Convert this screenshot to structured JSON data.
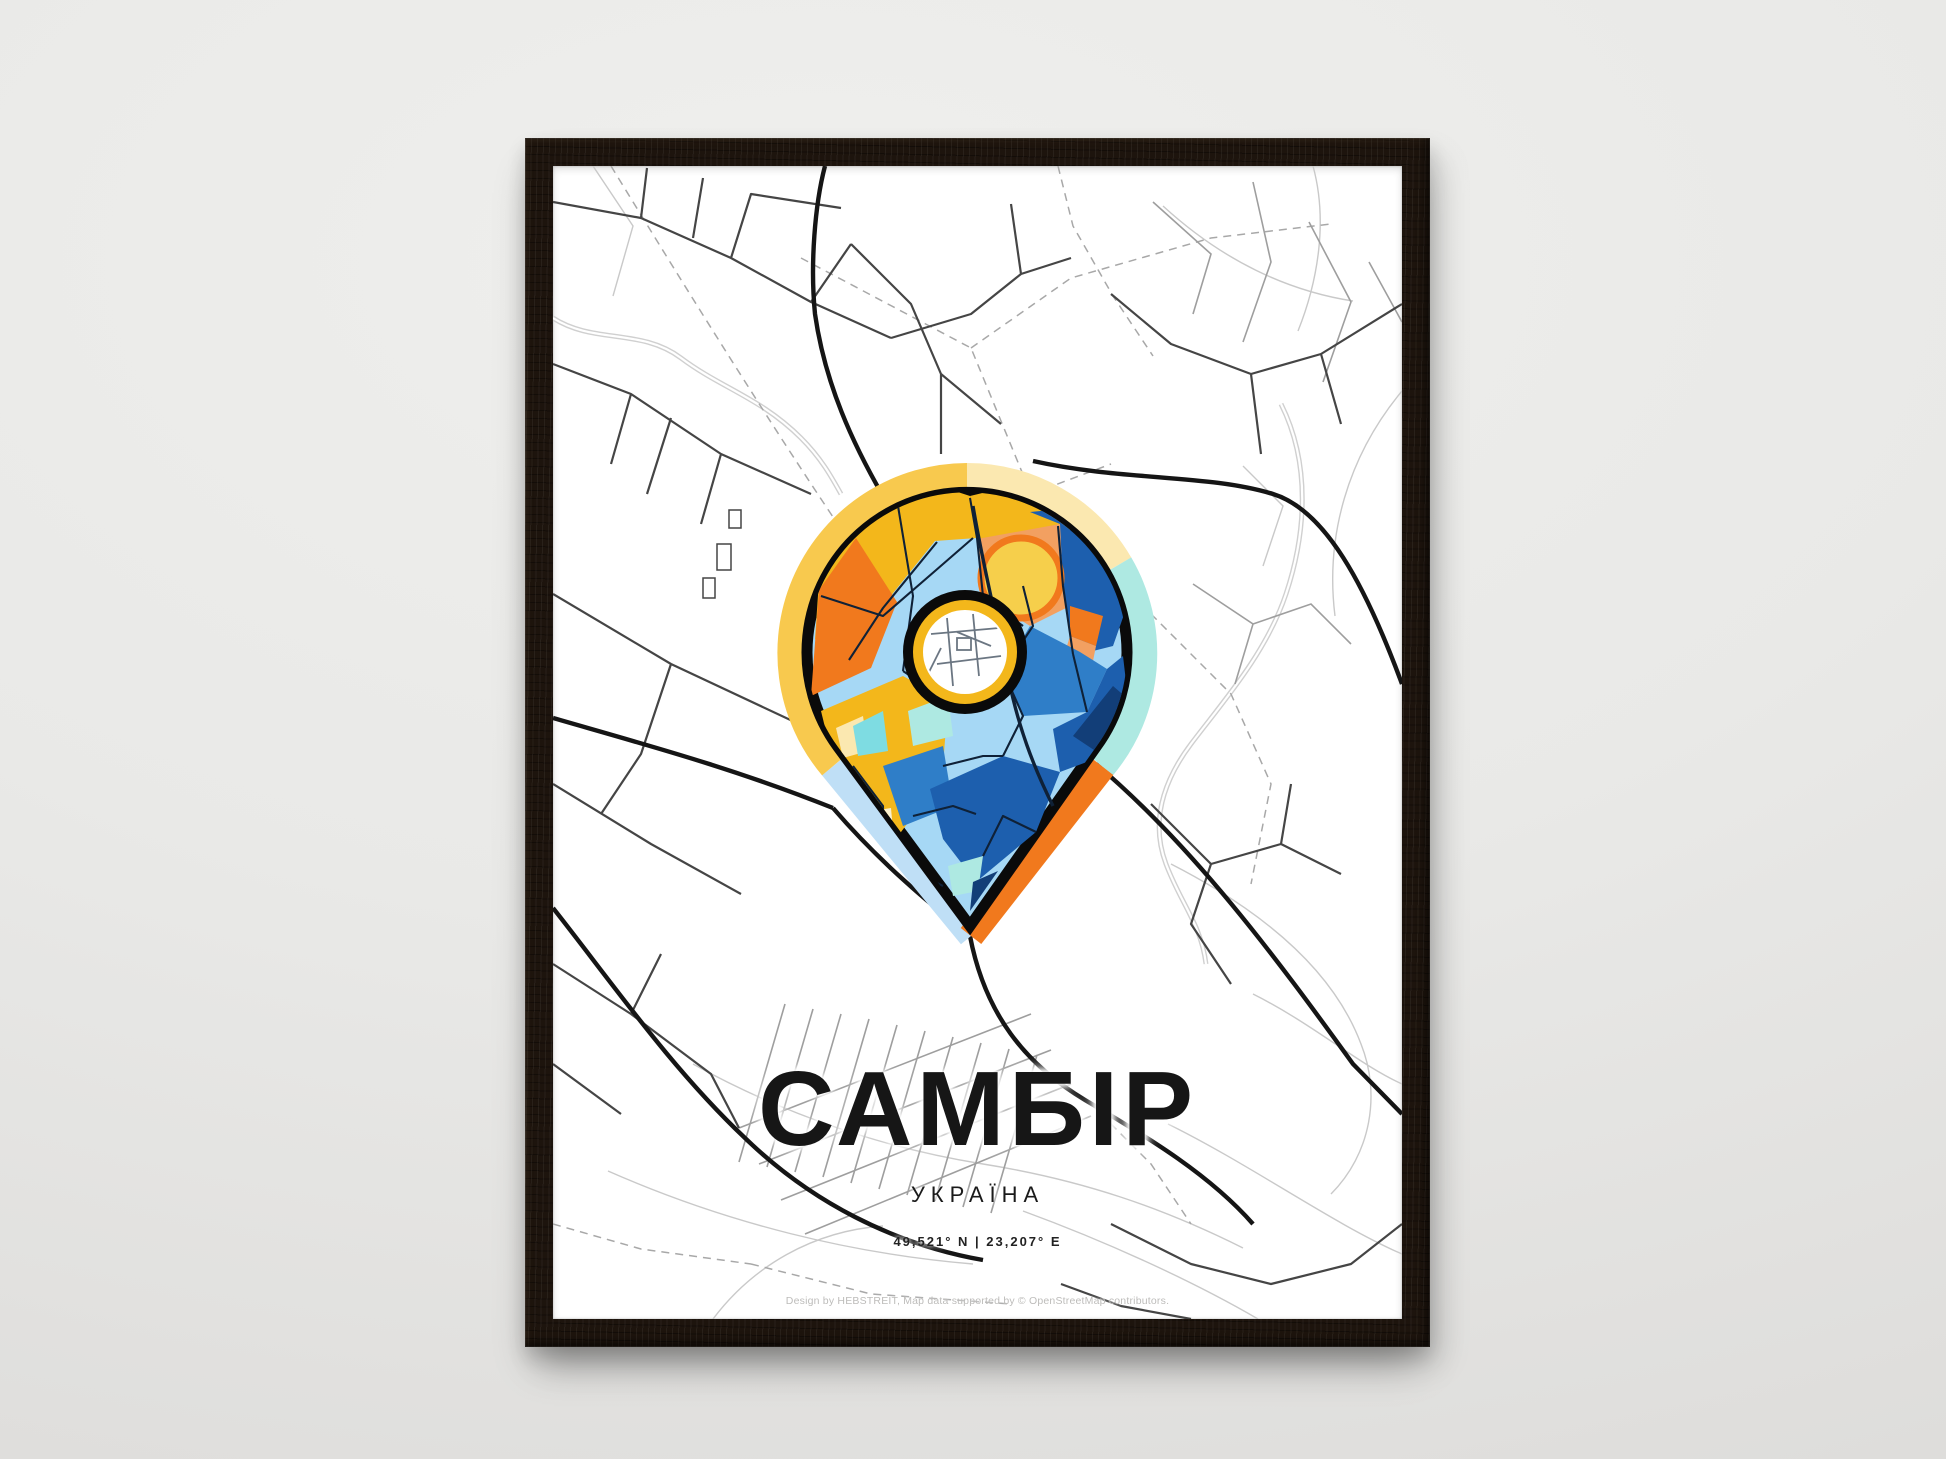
{
  "poster": {
    "title": "САМБІР",
    "subtitle": "УКРАЇНА",
    "coordinates": "49,521° N | 23,207° E",
    "credit": "Design by HEBSTREIT, Map data supported by © OpenStreetMap contributors."
  },
  "icons": {
    "pin": "map-pin-icon",
    "ring": "ring-roundabout-icon"
  },
  "colors": {
    "wall_top": "#efefed",
    "wall_bottom": "#dddcda",
    "frame_wood": "#1d140d",
    "paper": "#ffffff",
    "road_light": "#c9c9c9",
    "road_mid": "#9e9e9e",
    "road_dark": "#454545",
    "road_bold": "#151515",
    "road_dash": "#a8a8a8",
    "river": "#d0d0d0",
    "pin_gold": "#F3B71B",
    "pin_halo_gold": "#F8C94E",
    "pin_cream": "#FBE8B0",
    "pin_cream_pale": "#FAF0CF",
    "pin_orange": "#F1791D",
    "pin_salmon": "#F2A061",
    "pin_yellow": "#F6CF4B",
    "pin_lblue": "#A6D8F5",
    "pin_pale_blue": "#BFDFF6",
    "pin_sky": "#5FA8E0",
    "pin_mblue": "#2F7EC8",
    "pin_dblue": "#1D5FAE",
    "pin_navy": "#123E78",
    "pin_cyan": "#7EDCE2",
    "pin_pale_cyan": "#AEE9E2",
    "pin_street": "#0F2137",
    "pin_black": "#0A0A0A",
    "donut_street": "#6b7682"
  }
}
